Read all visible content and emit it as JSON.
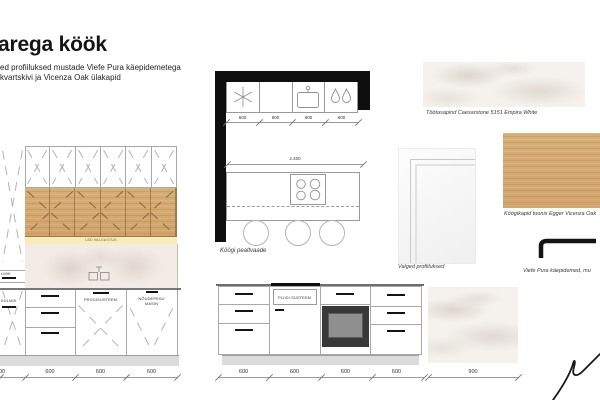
{
  "colors": {
    "oak_cabinet": "#d3a76e",
    "led_strip": "#f5eebb",
    "wall_black": "#0f0f0f",
    "marble_base": "#f5f2ed",
    "handle_black": "#141414"
  },
  "header": {
    "title": "arega köök",
    "subtitle_line1": "ed profiiluksed mustade Viefe Pura käepidemetega",
    "subtitle_line2": "kvartskivi ja Vicenza Oak ülakapid"
  },
  "left_elevation": {
    "fridge_label_fragment": "LMIK",
    "freezer_label_fragment": "KÜLMIK",
    "led_label": "LED VALGUSTUS",
    "waste_label": "PRÜGISÜSTEEM",
    "dishwasher_label_line1": "NÕUDEPESU",
    "dishwasher_label_line2": "MASIN",
    "dimensions": [
      "00",
      "600",
      "600",
      "600"
    ]
  },
  "plan_view": {
    "caption": "Köögi pealtvaade",
    "top_dimensions": [
      "600",
      "600",
      "600",
      "600"
    ],
    "island_width_dimension": "2.400"
  },
  "island_elevation": {
    "hob_label": "PLIIDI SÜSTEEM",
    "dimensions": [
      "600",
      "600",
      "600",
      "600"
    ]
  },
  "island_side_panel": {
    "width_dimension": "900"
  },
  "materials": {
    "worktop_caption": "Töötasapind Caesarstone 5151 Empira White",
    "doors_caption": "Valged profiiluksed",
    "cabinets_caption": "Köögikapid toonis Egger Vicenza Oak",
    "handles_caption": "Viefe Pura käepidemed, mu"
  }
}
